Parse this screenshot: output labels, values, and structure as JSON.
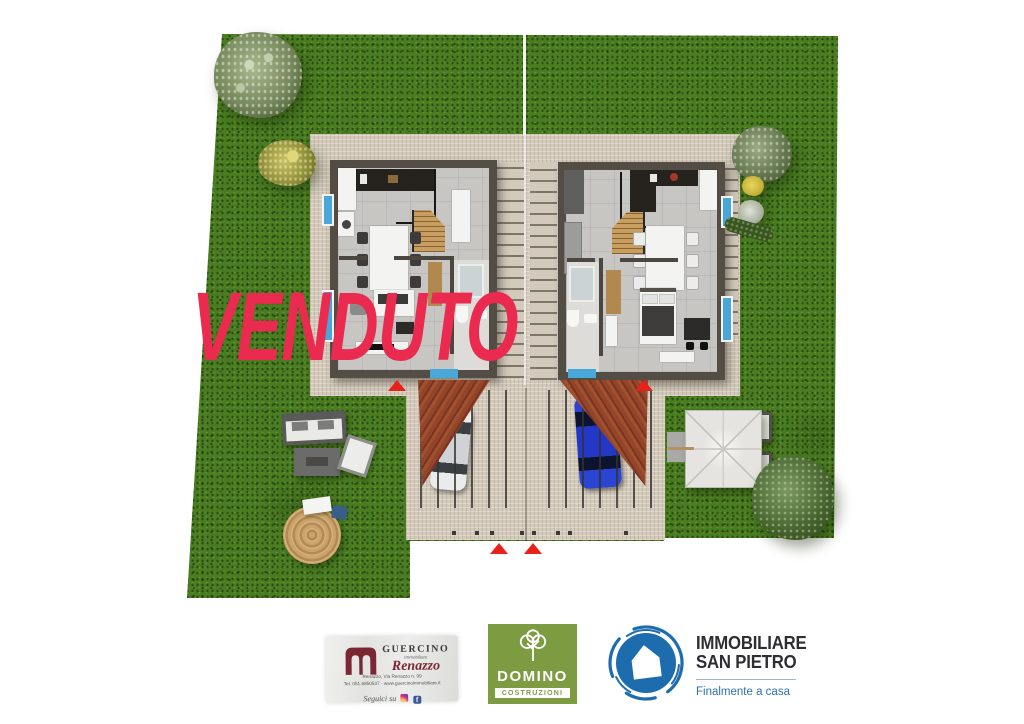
{
  "watermark": {
    "text": "VENDUTO"
  },
  "footer": {
    "guercino": {
      "name": "GUERCINO",
      "subtitle": "Immobiliare",
      "script": "Renazzo",
      "address": "Renazzo, Via Renazzo n. 99",
      "contact": "Tel. 051.6850537 - www.guercinoimmobiliare.it",
      "follow": "Seguici su",
      "facebook_letter": "f"
    },
    "domino": {
      "name": "DOMINO",
      "subtitle": "COSTRUZIONI"
    },
    "san_pietro": {
      "line1": "IMMOBILIARE",
      "line2": "SAN PIETRO",
      "tagline": "Finalmente a casa"
    }
  },
  "colors": {
    "grass": "#4a7d21",
    "patio": "#d3cabb",
    "wall": "#534d45",
    "floor": "#c7c6c3",
    "roof": "#94452a",
    "watermark-red": "#ea2a4e",
    "marker-red": "#e8211a",
    "glass-blue": "#44a3d6",
    "domino-green": "#7d9b40",
    "sanpietro-blue": "#1d6dae",
    "guercino-maroon": "#7b2733",
    "text-dark": "#2e2d32"
  }
}
